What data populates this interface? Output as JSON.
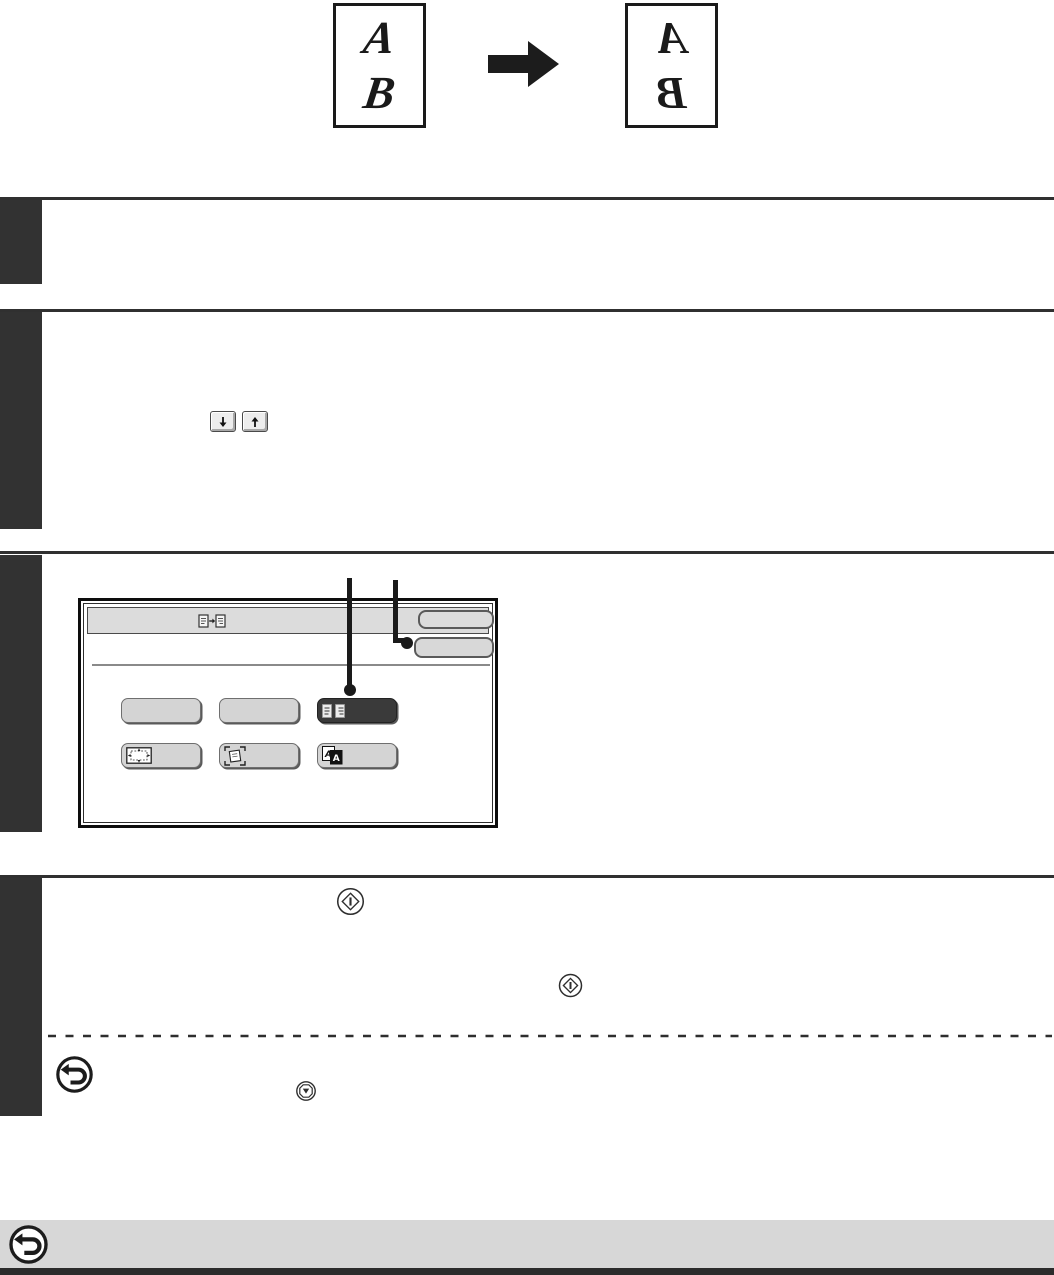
{
  "illustration": {
    "source_page_letters": [
      "A",
      "B"
    ],
    "result_page_letters": [
      "A",
      "B"
    ],
    "transformation": "mirror-image",
    "arrow_icon": "right-arrow-icon"
  },
  "sections": {
    "count": 4,
    "marker_style": "solid dark step blocks, no visible numbers"
  },
  "scroll_buttons": {
    "down_icon": "down-arrow-icon",
    "up_icon": "up-arrow-icon"
  },
  "touch_screen": {
    "header_icon": "special-modes-icon",
    "header_button_label": "",
    "action_button_label": "",
    "keys": [
      {
        "label": "",
        "selected": false,
        "icon": ""
      },
      {
        "label": "",
        "selected": false,
        "icon": ""
      },
      {
        "label": "",
        "selected": true,
        "icon": "mirror-image-icon"
      },
      {
        "label": "",
        "selected": false,
        "icon": "centering-icon"
      },
      {
        "label": "",
        "selected": false,
        "icon": "card-shot-icon"
      },
      {
        "label": "",
        "selected": false,
        "icon": "bw-reverse-icon"
      }
    ],
    "callout_count": 2
  },
  "symbols": {
    "start_key": "start-key-icon",
    "start_key_2": "start-key-icon",
    "stop_key": "stop-key-icon",
    "cancel_icon": "u-turn-arrow-icon",
    "footer_icon": "u-turn-arrow-icon"
  },
  "colors": {
    "ink": "#1c1c1c",
    "step_block": "#323232",
    "section_line": "#303030",
    "screen_header_bg": "#dcdcdc",
    "key_bg": "#d4d4d4",
    "key_selected_bg": "#3a3a3a",
    "footer_bar_bg": "#d7d7d7"
  }
}
